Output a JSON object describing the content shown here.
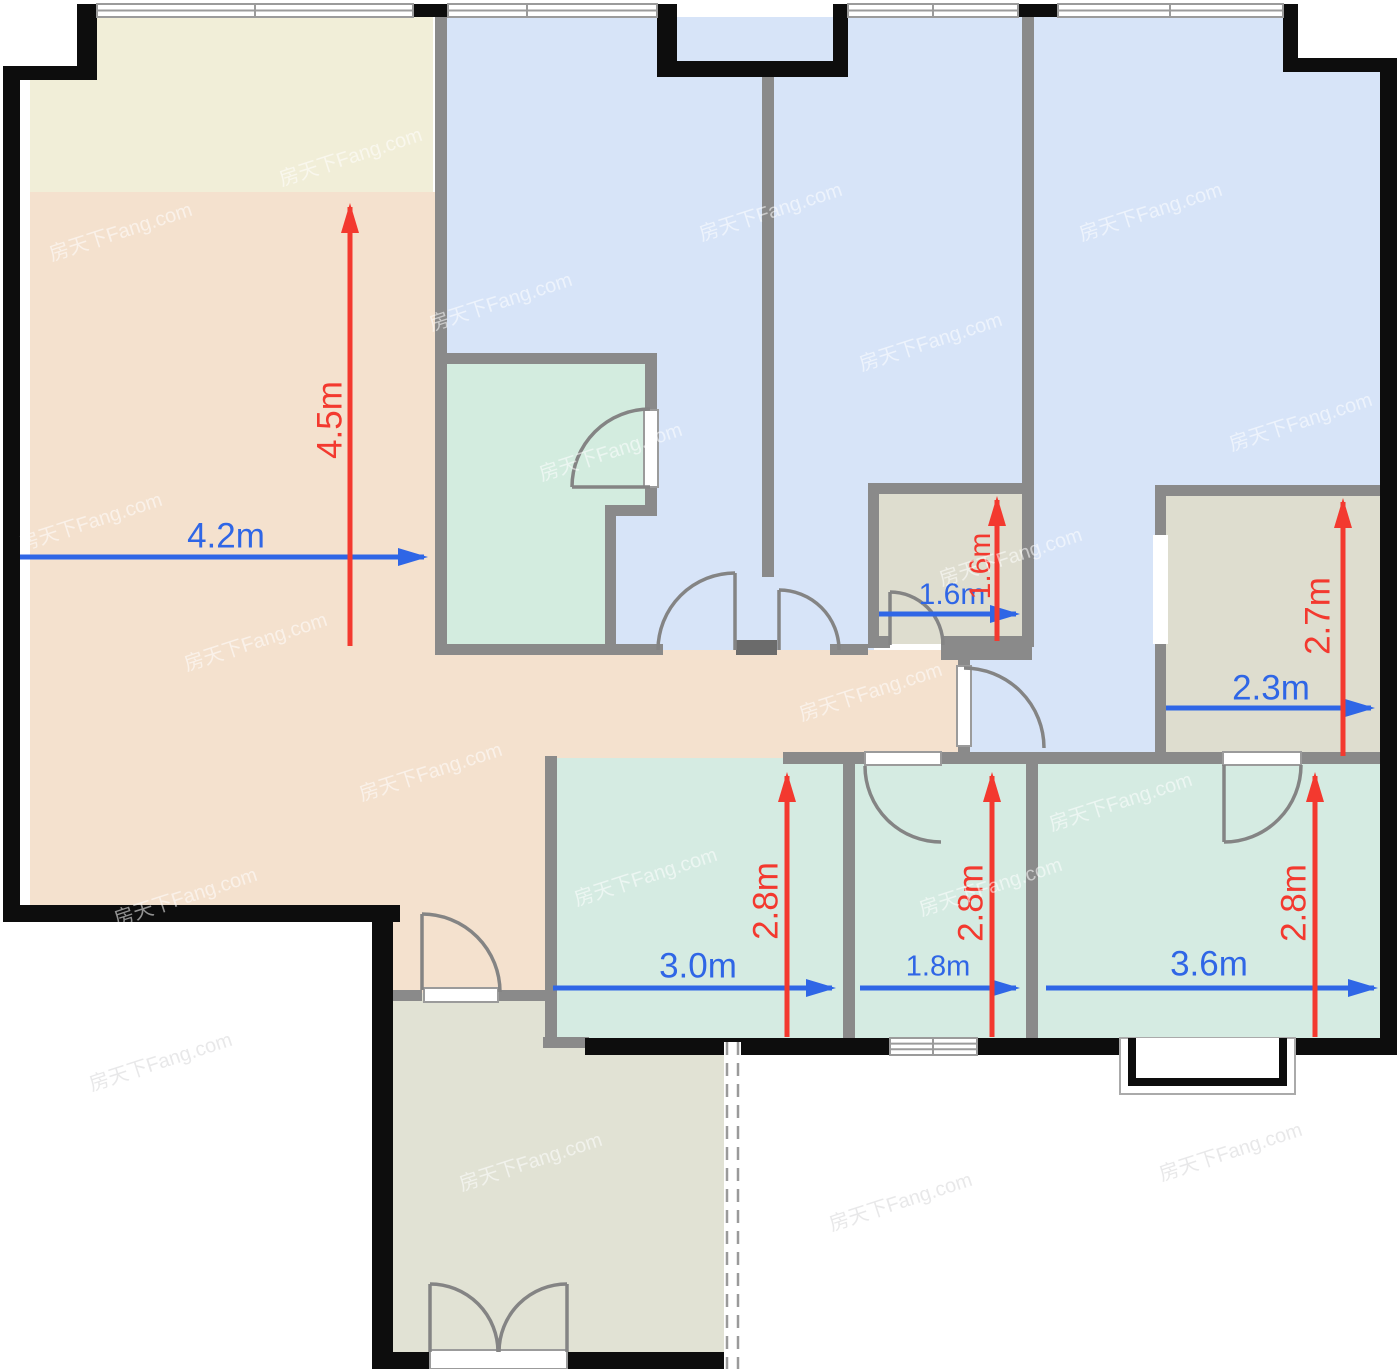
{
  "page": {
    "type": "apartment-floorplan",
    "background": "#ffffff"
  },
  "watermark": "房天下Fang.com",
  "palette": {
    "dimension_blue": "#2f66e6",
    "dimension_red": "#f3392f",
    "outer_wall": "#0d0d0d",
    "inner_wall": "#8a8a8a",
    "door_line": "#848484",
    "window_line": "#9b9b9b"
  },
  "rooms": [
    {
      "id": "balcony-north",
      "fill": "#f1eed8"
    },
    {
      "id": "living-dining",
      "fill": "#f4e1ce"
    },
    {
      "id": "bedroom-north-left",
      "fill": "#d7e4f8"
    },
    {
      "id": "ensuite-bathroom",
      "fill": "#d3ecdf"
    },
    {
      "id": "bedroom-north-middle",
      "fill": "#d7e4f8"
    },
    {
      "id": "closet",
      "fill": "#deddcf"
    },
    {
      "id": "bedroom-north-right",
      "fill": "#d7e4f8"
    },
    {
      "id": "study",
      "fill": "#deddcf"
    },
    {
      "id": "kitchen",
      "fill": "#d5ebe2"
    },
    {
      "id": "bathroom-south",
      "fill": "#d5ebe2"
    },
    {
      "id": "bedroom-south",
      "fill": "#d5ebe2"
    },
    {
      "id": "balcony-south",
      "fill": "#e1e2d4"
    }
  ],
  "dims": [
    {
      "id": "living-width",
      "label": "4.2m",
      "value": 4.2,
      "axis": "horizontal",
      "color": "#2f66e6"
    },
    {
      "id": "living-depth",
      "label": "4.5m",
      "value": 4.5,
      "axis": "vertical",
      "color": "#f3392f"
    },
    {
      "id": "closet-width",
      "label": "1.6m",
      "value": 1.6,
      "axis": "horizontal",
      "color": "#2f66e6"
    },
    {
      "id": "closet-depth",
      "label": "1.6m",
      "value": 1.6,
      "axis": "vertical",
      "color": "#f3392f"
    },
    {
      "id": "study-width",
      "label": "2.3m",
      "value": 2.3,
      "axis": "horizontal",
      "color": "#2f66e6"
    },
    {
      "id": "study-depth",
      "label": "2.7m",
      "value": 2.7,
      "axis": "vertical",
      "color": "#f3392f"
    },
    {
      "id": "kitchen-width",
      "label": "3.0m",
      "value": 3.0,
      "axis": "horizontal",
      "color": "#2f66e6"
    },
    {
      "id": "kitchen-depth",
      "label": "2.8m",
      "value": 2.8,
      "axis": "vertical",
      "color": "#f3392f"
    },
    {
      "id": "bath-south-width",
      "label": "1.8m",
      "value": 1.8,
      "axis": "horizontal",
      "color": "#2f66e6"
    },
    {
      "id": "bath-south-depth",
      "label": "2.8m",
      "value": 2.8,
      "axis": "vertical",
      "color": "#f3392f"
    },
    {
      "id": "bedroom-south-width",
      "label": "3.6m",
      "value": 3.6,
      "axis": "horizontal",
      "color": "#2f66e6"
    },
    {
      "id": "bedroom-south-depth",
      "label": "2.8m",
      "value": 2.8,
      "axis": "vertical",
      "color": "#f3392f"
    }
  ]
}
